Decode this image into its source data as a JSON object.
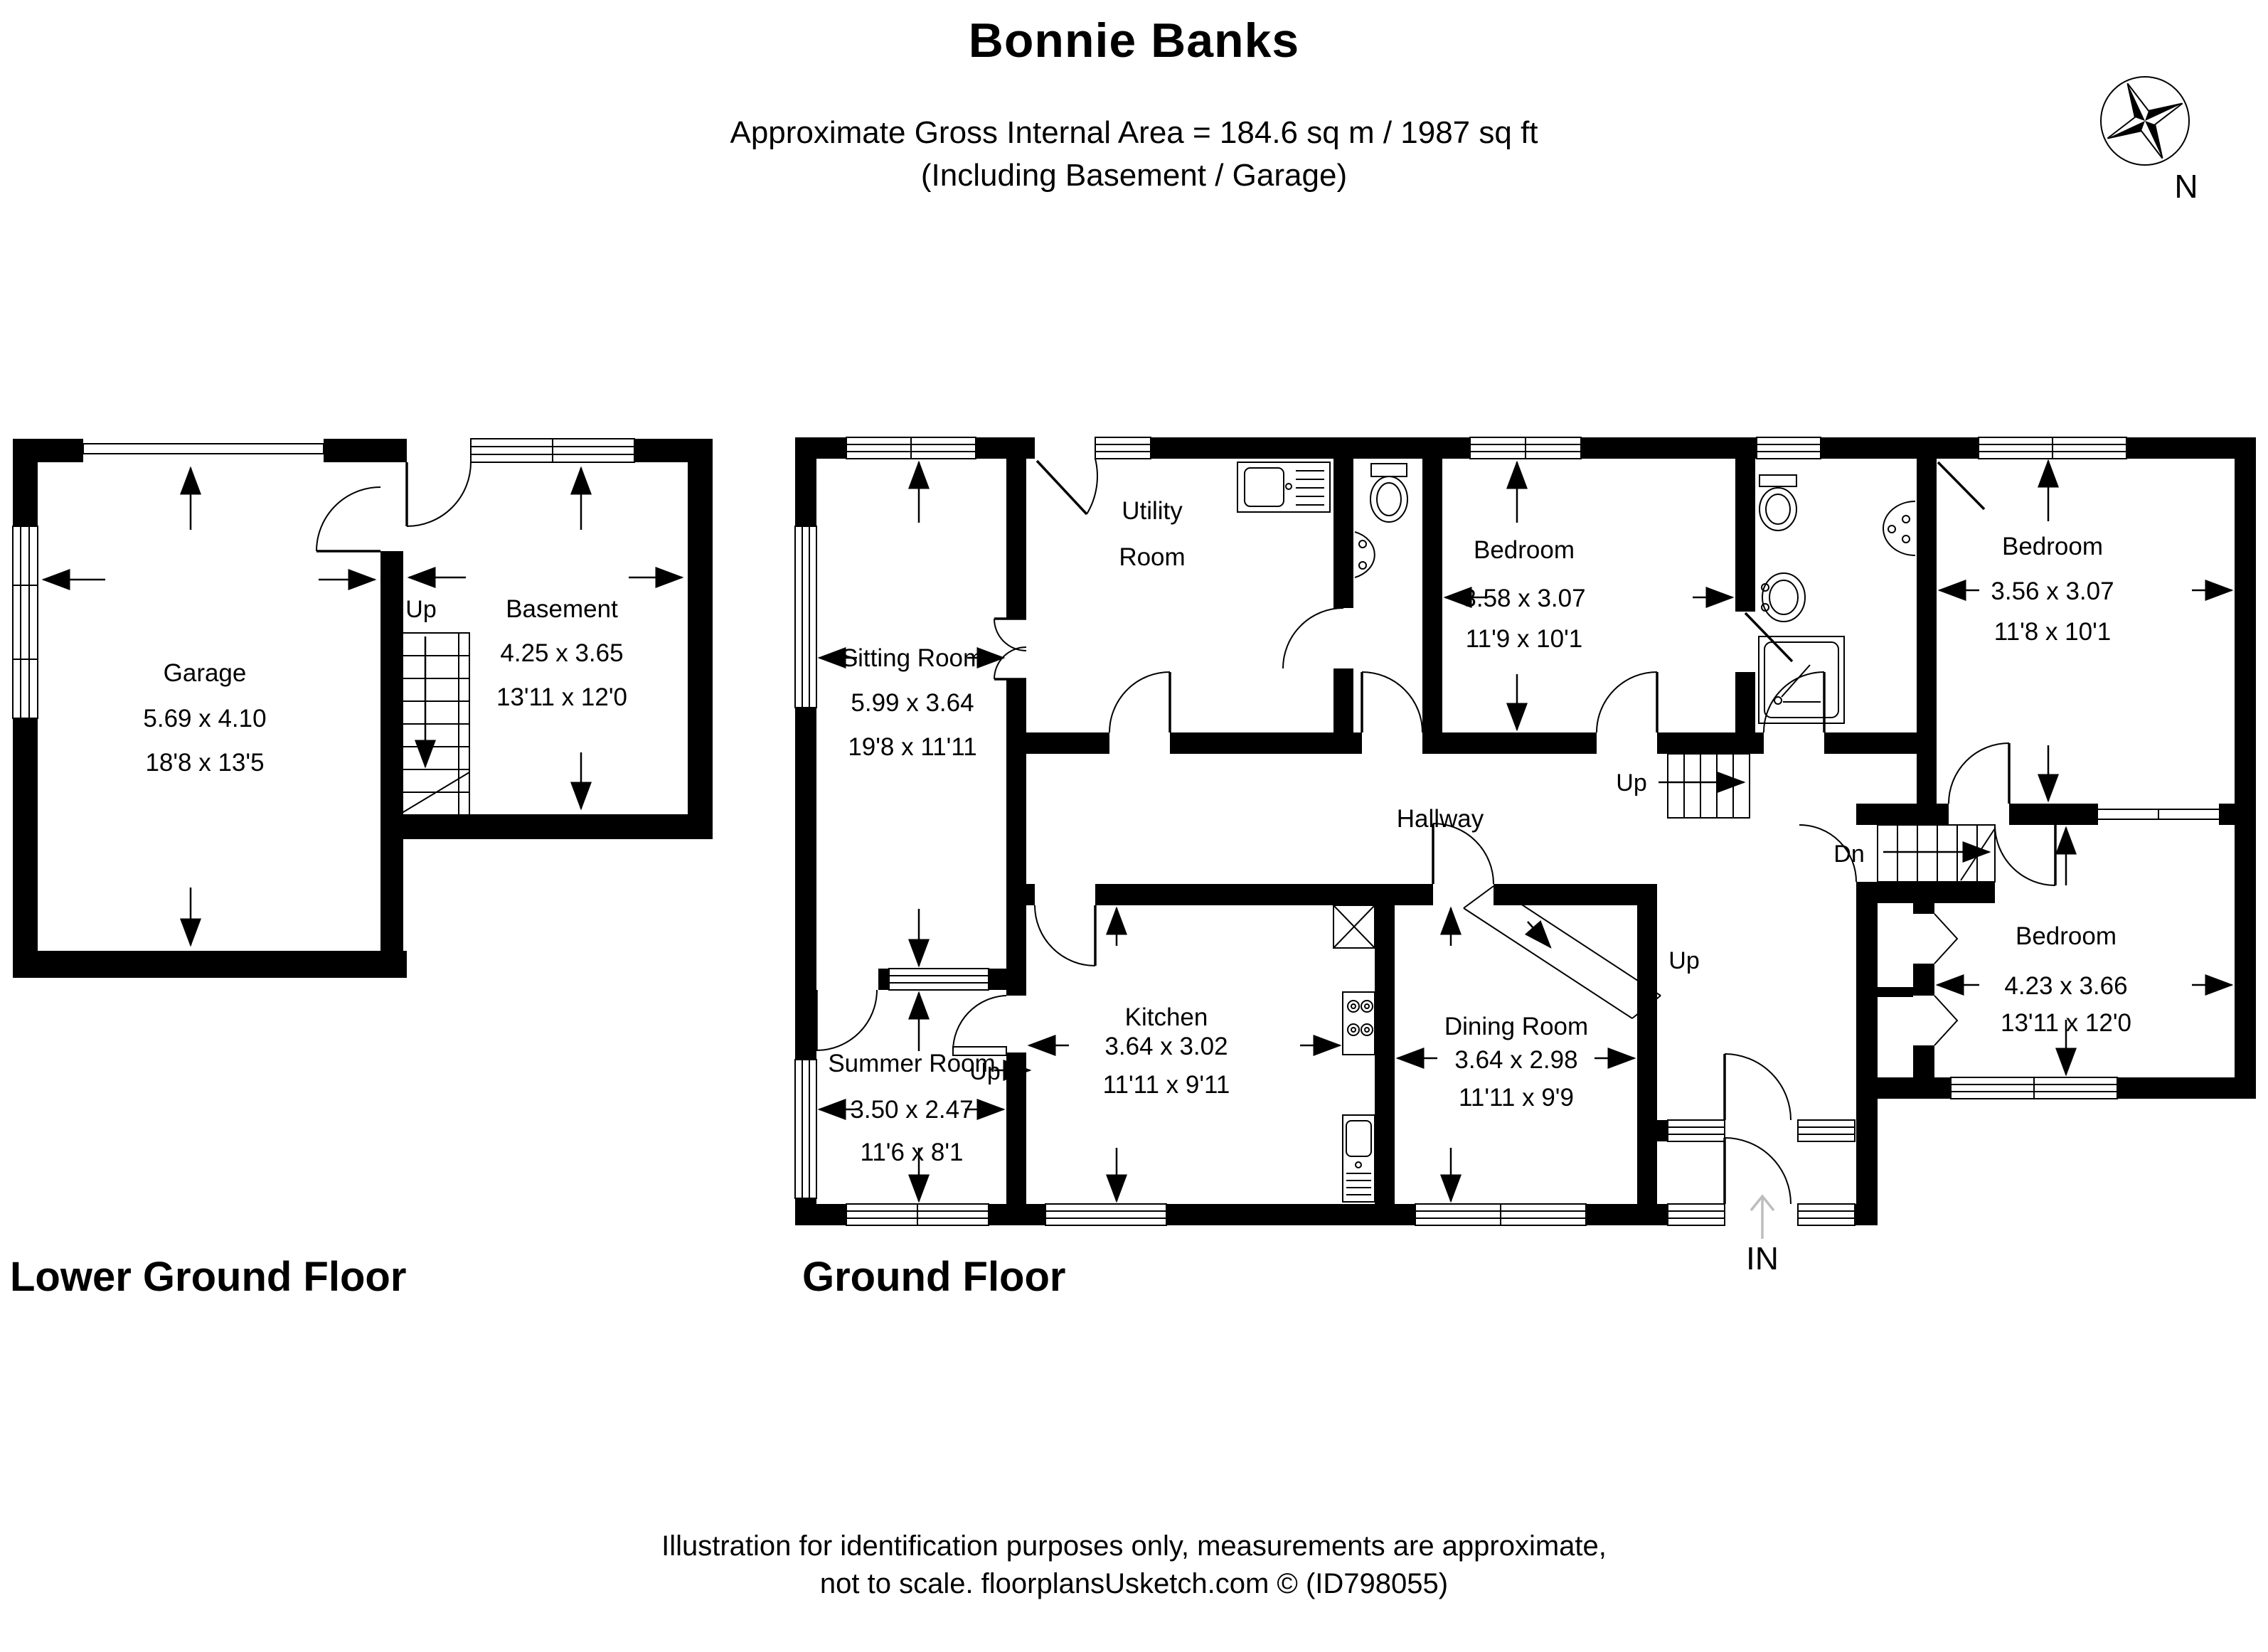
{
  "header": {
    "title": "Bonnie Banks",
    "subtitle_line1": "Approximate Gross Internal Area = 184.6 sq m / 1987 sq ft",
    "subtitle_line2": "(Including Basement / Garage)"
  },
  "compass": {
    "north_label": "N"
  },
  "lower_ground_floor": {
    "label": "Lower Ground Floor",
    "garage": {
      "name": "Garage",
      "metric": "5.69 x 4.10",
      "imperial": "18'8 x 13'5"
    },
    "basement": {
      "name": "Basement",
      "metric": "4.25 x 3.65",
      "imperial": "13'11 x 12'0"
    },
    "stairs_up_label": "Up"
  },
  "ground_floor": {
    "label": "Ground Floor",
    "sitting_room": {
      "name": "Sitting Room",
      "metric": "5.99 x 3.64",
      "imperial": "19'8 x 11'11"
    },
    "utility_room": {
      "name": "Utility Room",
      "line1": "Utility",
      "line2": "Room"
    },
    "bedroom1": {
      "name": "Bedroom",
      "metric": "3.58 x 3.07",
      "imperial": "11'9 x 10'1"
    },
    "bedroom2": {
      "name": "Bedroom",
      "metric": "3.56 x 3.07",
      "imperial": "11'8 x 10'1"
    },
    "bedroom3": {
      "name": "Bedroom",
      "metric": "4.23 x 3.66",
      "imperial": "13'11 x 12'0"
    },
    "hallway": {
      "name": "Hallway"
    },
    "summer_room": {
      "name": "Summer Room",
      "metric": "3.50 x 2.47",
      "imperial": "11'6 x 8'1"
    },
    "kitchen": {
      "name": "Kitchen",
      "metric": "3.64 x 3.02",
      "imperial": "11'11 x 9'11"
    },
    "dining_room": {
      "name": "Dining Room",
      "metric": "3.64 x 2.98",
      "imperial": "11'11 x 9'9"
    },
    "stairs": {
      "up_main": "Up",
      "up_ramp": "Up",
      "up_step": "Up",
      "down": "Dn"
    },
    "entrance_label": "IN"
  },
  "footer": {
    "line1": "Illustration for identification purposes only, measurements are approximate,",
    "line2": "not to scale. floorplansUsketch.com © (ID798055)"
  }
}
